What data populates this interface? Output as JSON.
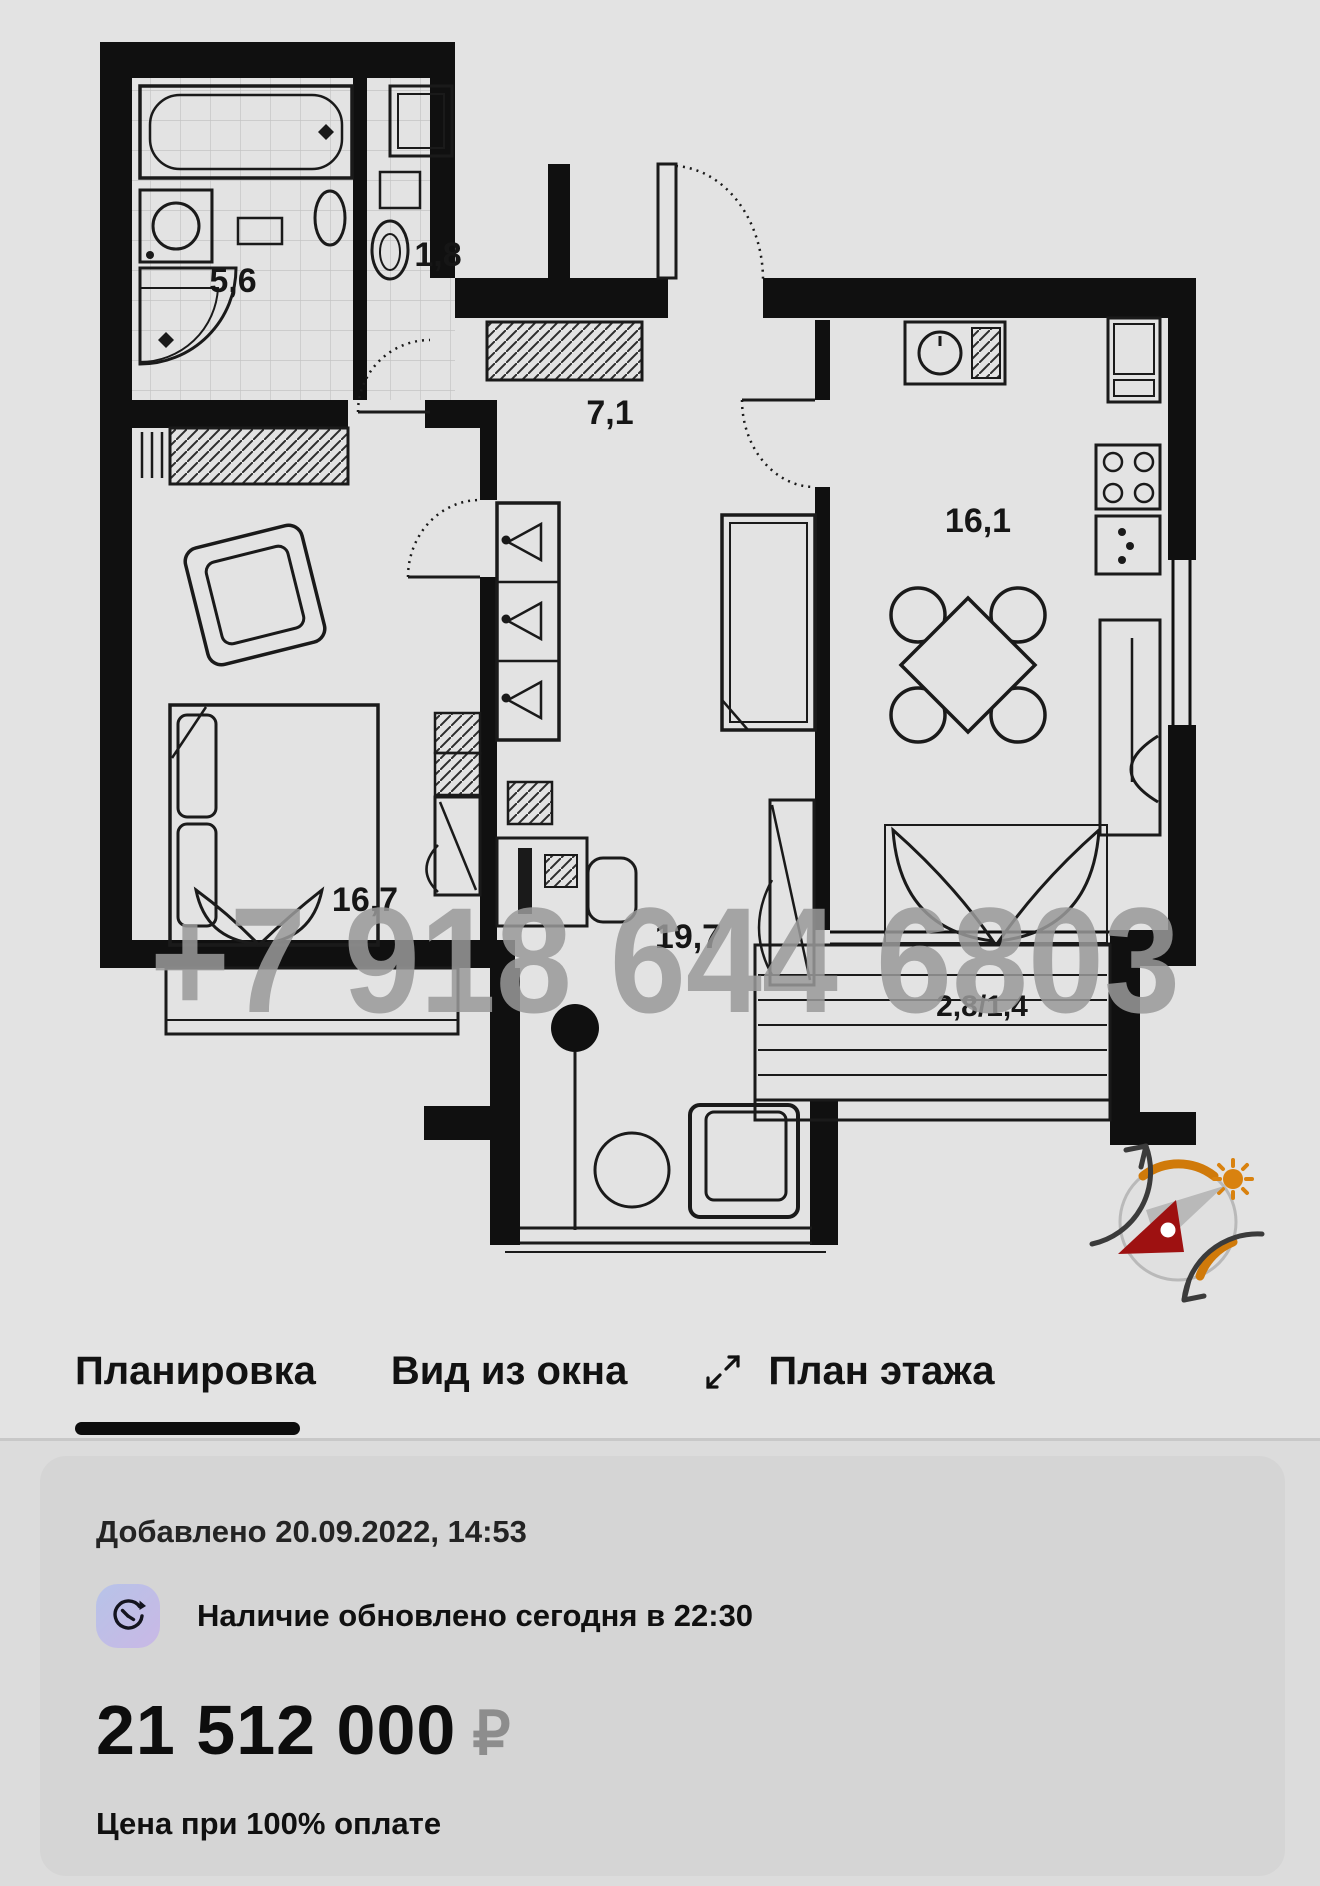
{
  "plan": {
    "labels": {
      "bathroom": "5,6",
      "wc": "1,8",
      "hallway": "7,1",
      "kitchen": "16,1",
      "bedroom": "16,7",
      "living": "19,7",
      "balcony": "2,8/1,4"
    },
    "watermark": "+7 918 644 6803"
  },
  "tabs": {
    "layout": "Планировка",
    "view": "Вид из окна",
    "floor": "План этажа"
  },
  "card": {
    "added": "Добавлено 20.09.2022, 14:53",
    "availability": "Наличие обновлено сегодня в 22:30",
    "price": "21 512 000",
    "currency": "₽",
    "note": "Цена при 100% оплате"
  },
  "colors": {
    "walls": "#101010",
    "background": "#e3e3e3",
    "watermark_gray": "#9a9a9a",
    "compass_orange": "#d07a0a",
    "compass_red": "#9e1111",
    "icon_gradient_start": "#b7c3e8",
    "icon_gradient_end": "#c9b8e5"
  }
}
